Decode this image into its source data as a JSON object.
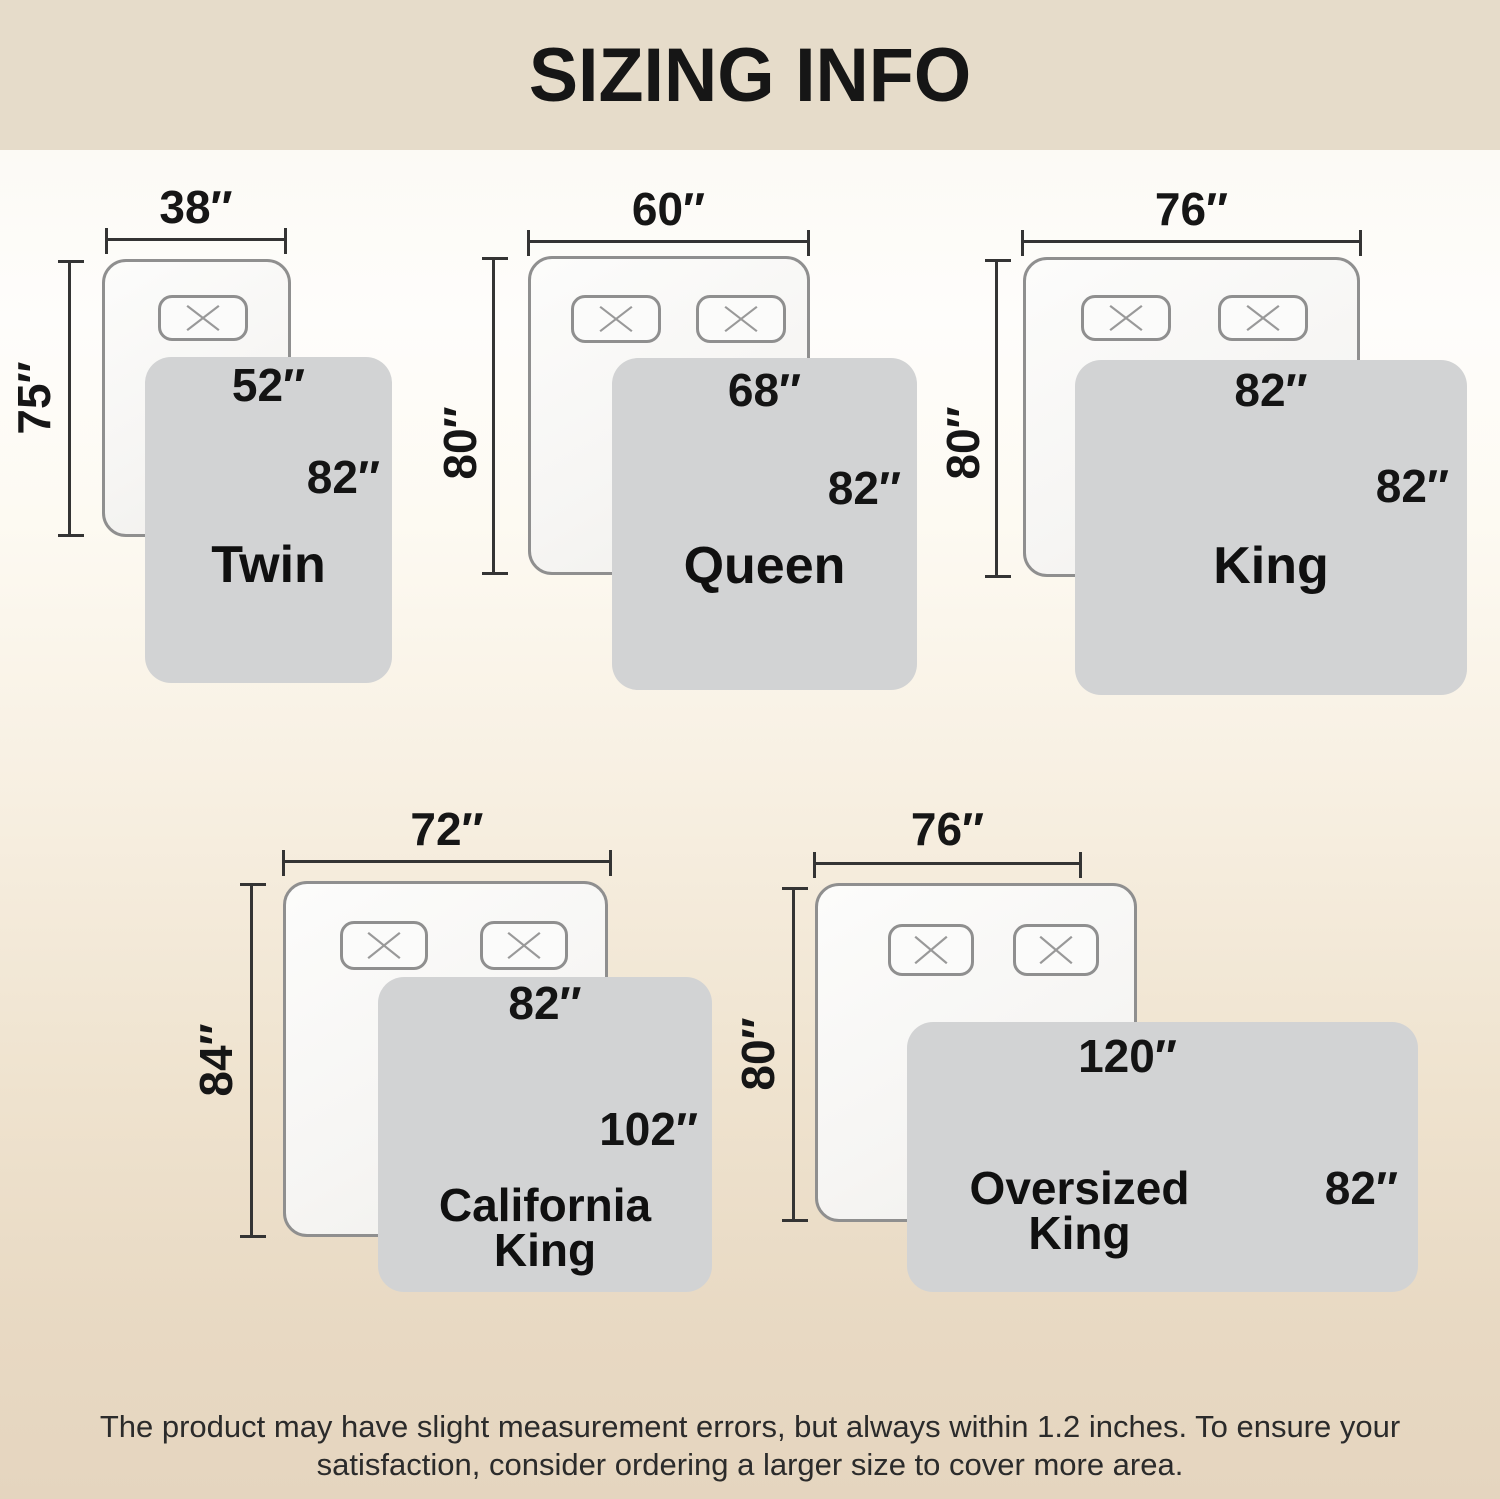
{
  "header": {
    "title": "SIZING INFO"
  },
  "colors": {
    "header_bg": "#e6dcca",
    "page_bottom_beige": "#e5d5bf",
    "blanket_gray": "#d2d3d4",
    "bed_fill": "#f8f7f5",
    "outline_gray": "#8f8f8f",
    "dimension_line": "#343434",
    "text": "#161616"
  },
  "icons": {
    "pillow_marker": "x-cross"
  },
  "sizes": [
    {
      "name_line1": "Twin",
      "name_line2": "",
      "mattress_width": "38″",
      "mattress_length": "75″",
      "blanket_width": "52″",
      "blanket_length": "82″"
    },
    {
      "name_line1": "Queen",
      "name_line2": "",
      "mattress_width": "60″",
      "mattress_length": "80″",
      "blanket_width": "68″",
      "blanket_length": "82″"
    },
    {
      "name_line1": "King",
      "name_line2": "",
      "mattress_width": "76″",
      "mattress_length": "80″",
      "blanket_width": "82″",
      "blanket_length": "82″"
    },
    {
      "name_line1": "California",
      "name_line2": "King",
      "mattress_width": "72″",
      "mattress_length": "84″",
      "blanket_width": "82″",
      "blanket_length": "102″"
    },
    {
      "name_line1": "Oversized",
      "name_line2": "King",
      "mattress_width": "76″",
      "mattress_length": "80″",
      "blanket_width": "120″",
      "blanket_length": "82″"
    }
  ],
  "footer": {
    "line1": "The product may have slight measurement errors, but always within 1.2 inches. To ensure your",
    "line2": "satisfaction, consider ordering a larger size to cover more area."
  }
}
